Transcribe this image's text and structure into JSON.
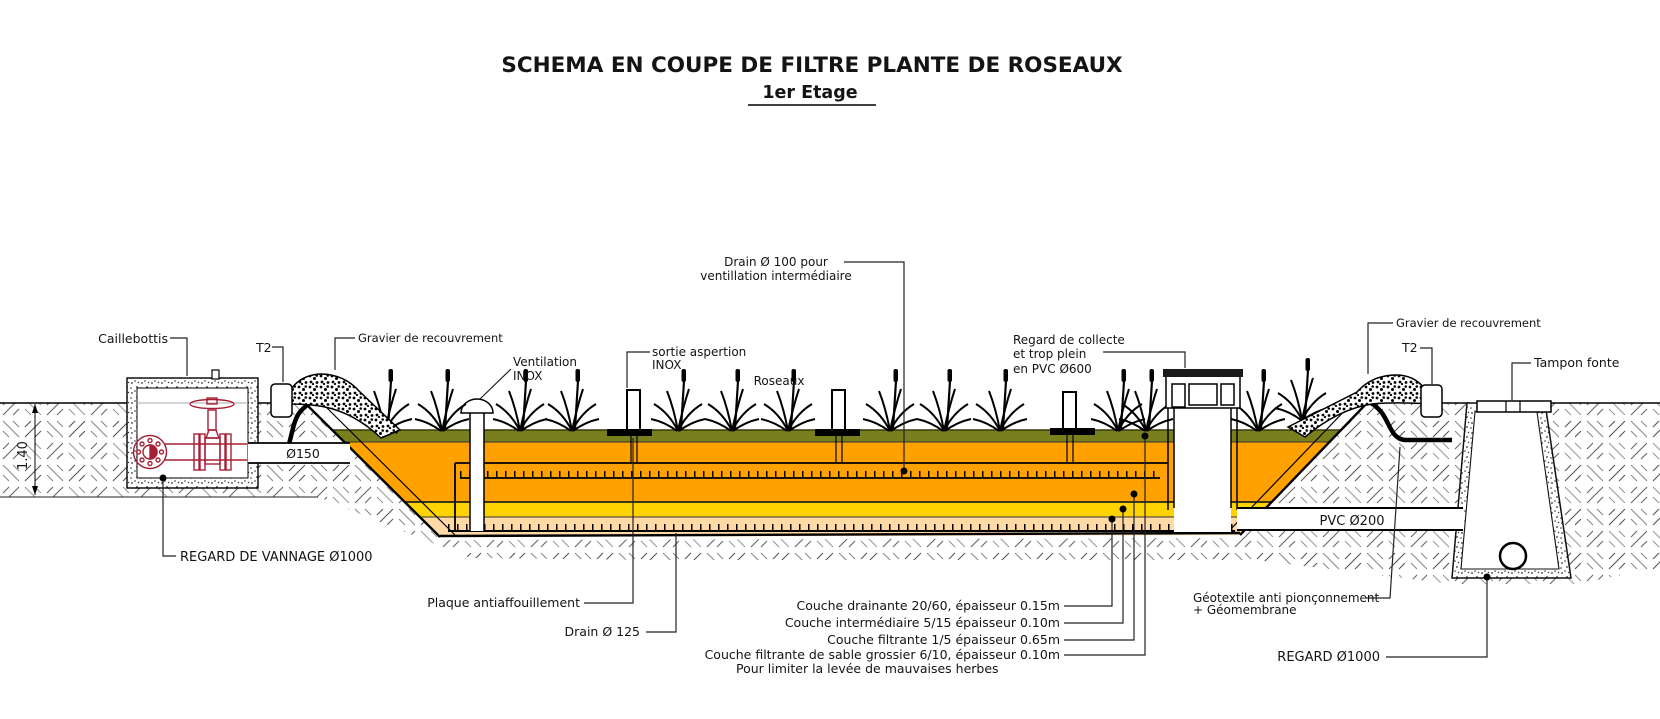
{
  "title": {
    "line1": "SCHEMA EN COUPE DE FILTRE PLANTE DE ROSEAUX",
    "line2": "1er Etage"
  },
  "colors": {
    "green": "#7a7f1d",
    "orange": "#ffa200",
    "yellow": "#ffd300",
    "peach": "#ffd9a6",
    "valve_red": "#a81e35"
  },
  "layers": [
    {
      "name": "couche sable grossier",
      "color_ref": "green"
    },
    {
      "name": "couche filtrante",
      "color_ref": "orange"
    },
    {
      "name": "couche intermediaire",
      "color_ref": "yellow"
    },
    {
      "name": "couche drainante",
      "color_ref": "peach"
    }
  ],
  "labels": {
    "caillebottis": "Caillebottis",
    "t2_left": "T2",
    "t2_right": "T2",
    "gravier_left": "Gravier de recouvrement",
    "gravier_right": "Gravier de recouvrement",
    "ventilation_1": "Ventilation",
    "ventilation_2": "INOX",
    "sortie_1": "sortie aspertion",
    "sortie_2": "INOX",
    "drain100_1": "Drain Ø 100 pour",
    "drain100_2": "ventillation intermédiaire",
    "roseaux": "Roseaux",
    "regard_collecte_1": "Regard de collecte",
    "regard_collecte_2": "et trop plein",
    "regard_collecte_3": "en PVC Ø600",
    "tampon_fonte": "Tampon fonte",
    "diam150": "Ø150",
    "pvc200": "PVC Ø200",
    "regard_vannage": "REGARD DE VANNAGE Ø1000",
    "plaque": "Plaque antiaffouillement",
    "drain125": "Drain Ø 125",
    "couche_drainante": "Couche drainante 20/60, épaisseur 0.15m",
    "couche_intermediaire": "Couche intermédiaire 5/15  épaisseur 0.10m",
    "couche_filtrante": "Couche filtrante 1/5 épaisseur 0.65m",
    "couche_sable": "Couche filtrante de sable grossier 6/10, épaisseur 0.10m",
    "pour_limiter": "Pour limiter la levée de mauvaises herbes",
    "geotextile_1": "Géotextile anti pionçonnement",
    "geotextile_2": "+ Géomembrane",
    "regard_1000": "REGARD Ø1000",
    "dim_140": "1.40"
  }
}
